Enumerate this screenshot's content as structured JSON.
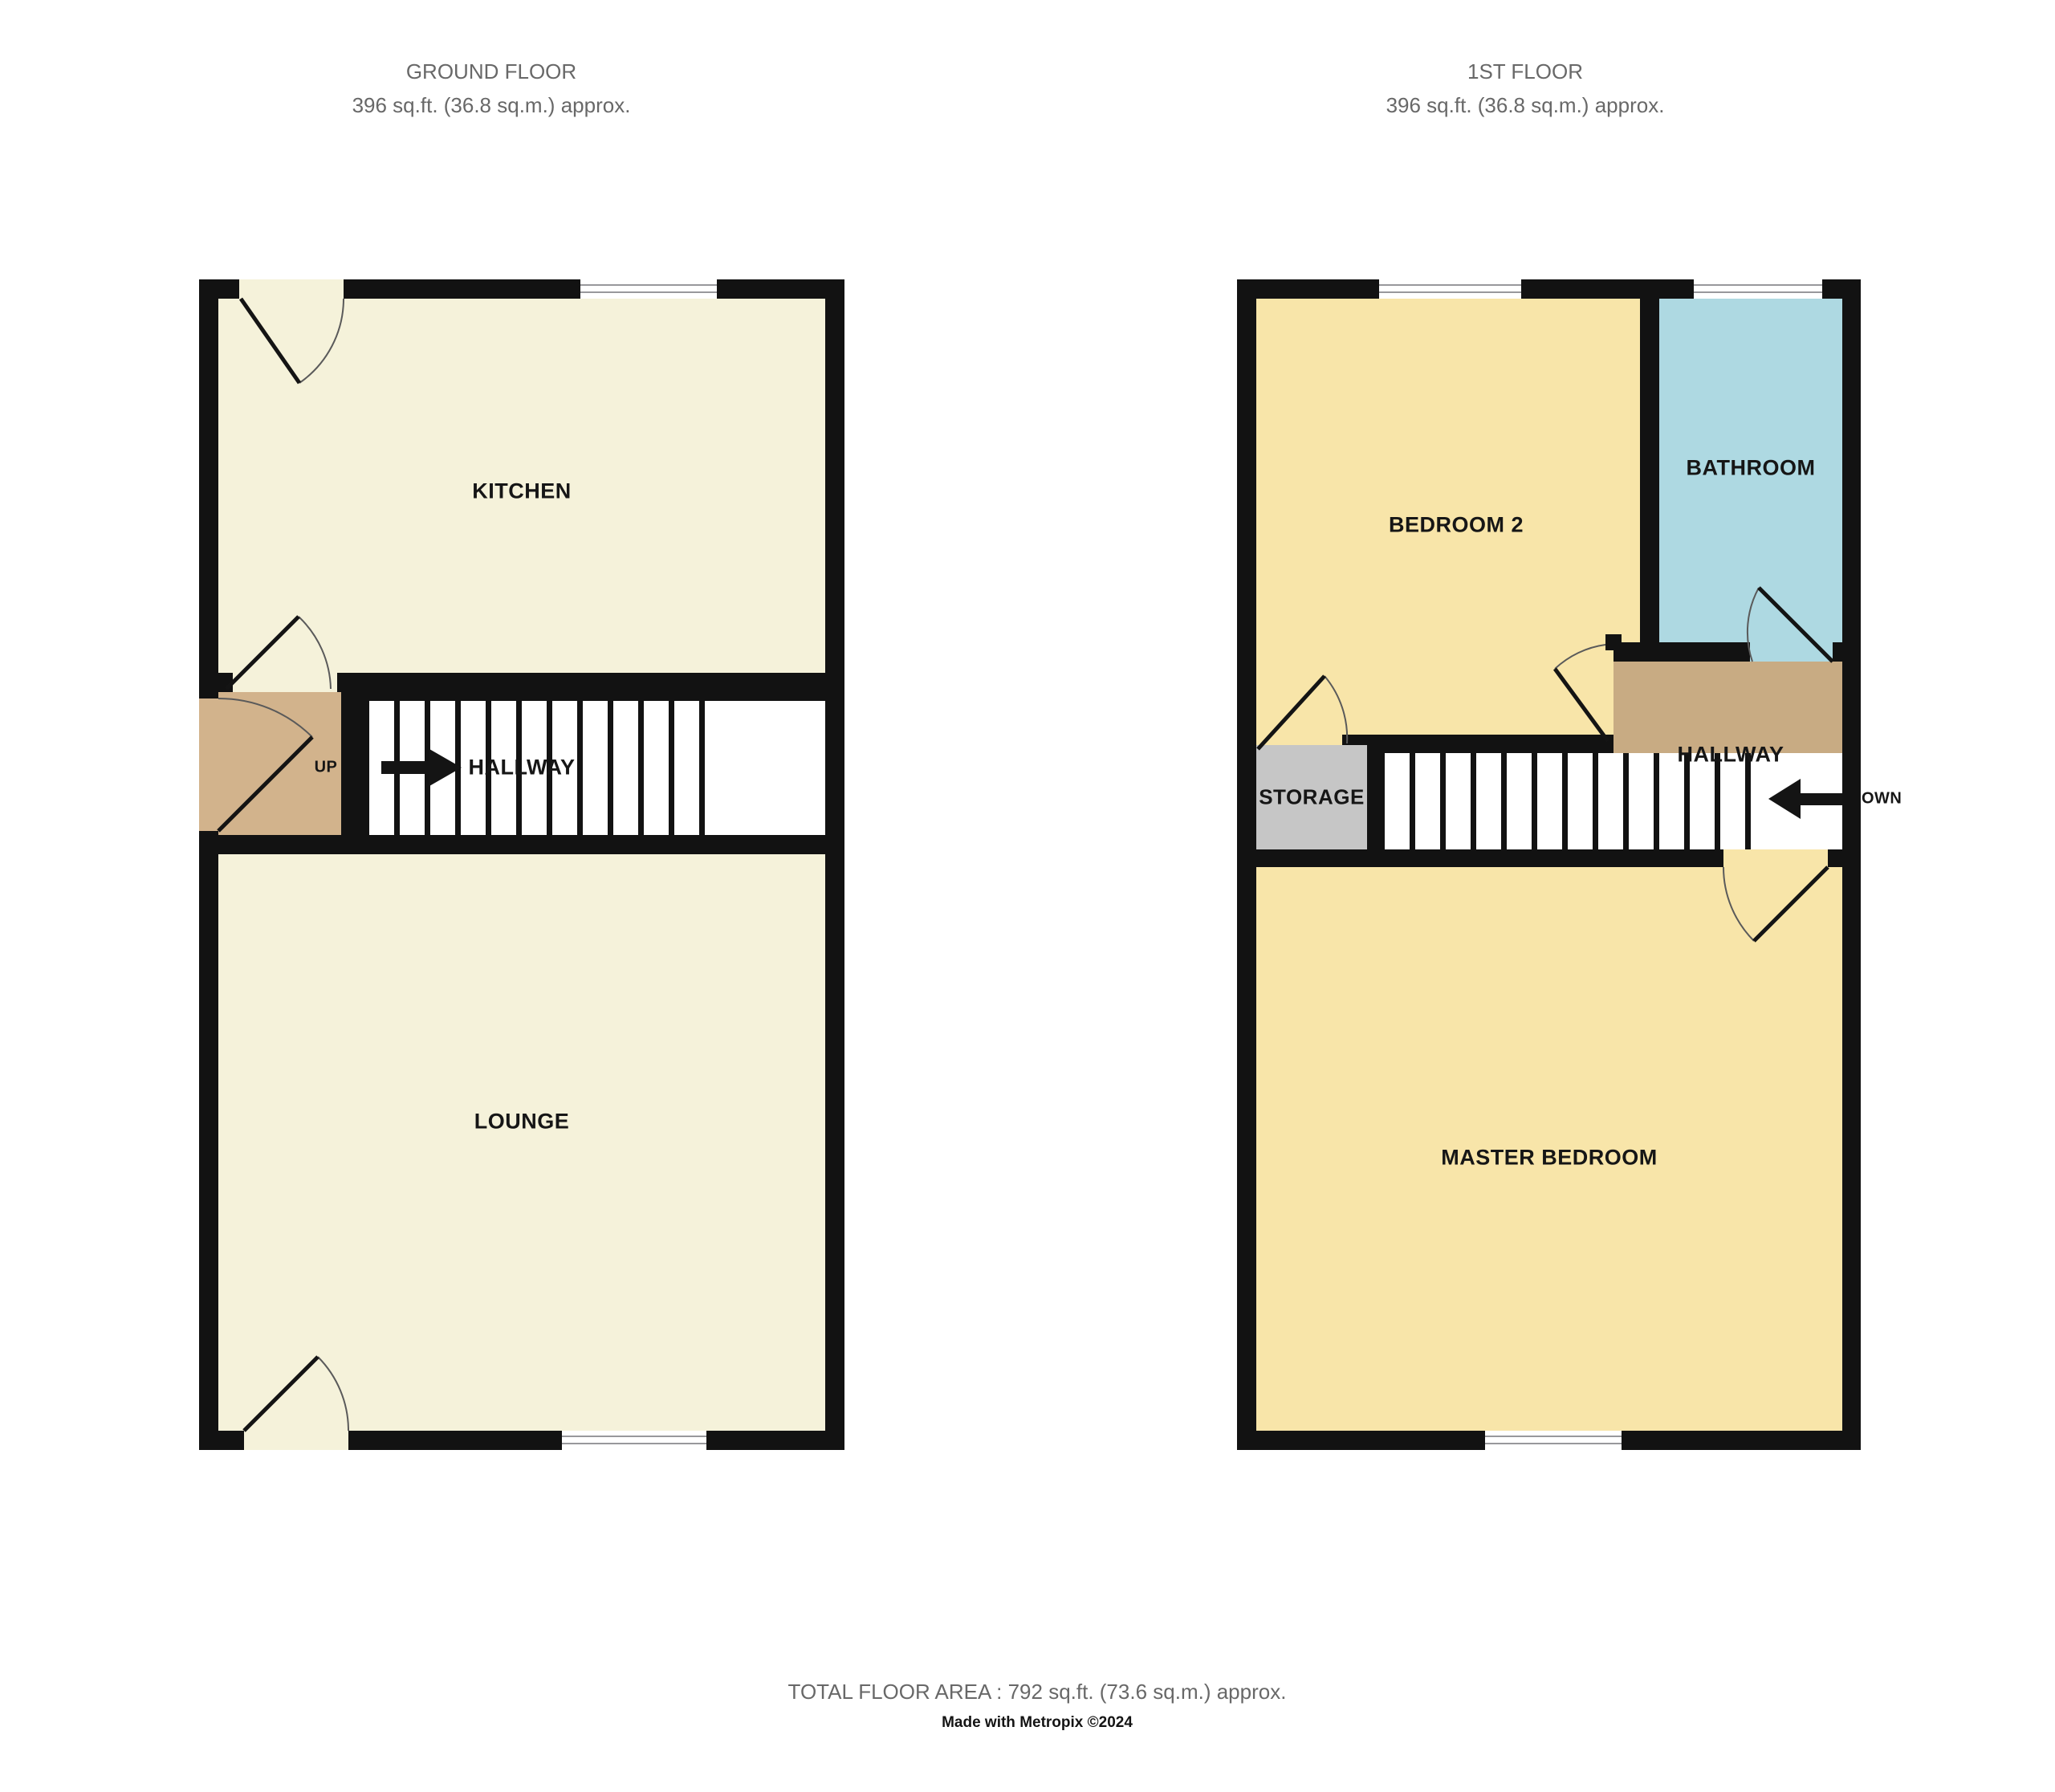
{
  "titles": {
    "ground_floor": {
      "line1": "GROUND FLOOR",
      "line2": "396 sq.ft. (36.8 sq.m.) approx."
    },
    "first_floor": {
      "line1": "1ST FLOOR",
      "line2": "396 sq.ft. (36.8 sq.m.) approx."
    }
  },
  "ground_floor": {
    "rooms": {
      "kitchen": "KITCHEN",
      "hallway": "HALLWAY",
      "lounge": "LOUNGE",
      "up": "UP"
    }
  },
  "first_floor": {
    "rooms": {
      "bedroom2": "BEDROOM 2",
      "bathroom": "BATHROOM",
      "hallway": "HALLWAY",
      "storage": "STORAGE",
      "master_bedroom": "MASTER BEDROOM",
      "down": "DOWN"
    }
  },
  "footer": {
    "total_area": "TOTAL FLOOR AREA : 792 sq.ft. (73.6 sq.m.) approx.",
    "credit": "Made with Metropix ©2024"
  },
  "colors": {
    "wall": "#121212",
    "cream": "#f5f2da",
    "yellow": "#f8e5a9",
    "blue": "#aed9e2",
    "tanGf": "#d2b38c",
    "tanFf": "#c8ab83",
    "storageGray": "#c6c6c6",
    "winLine": "#98989c",
    "titleGray": "#686868"
  }
}
